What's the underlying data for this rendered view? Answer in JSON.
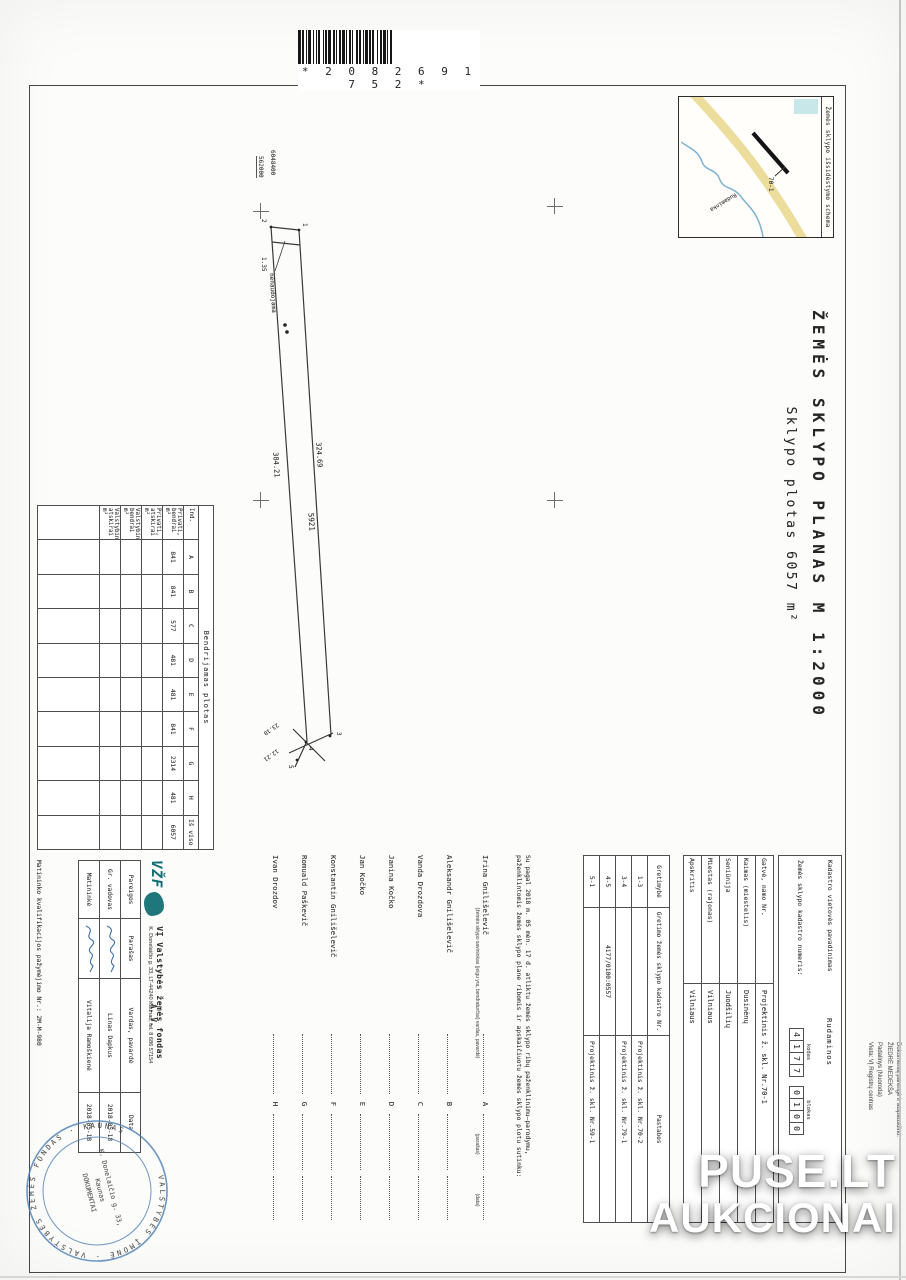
{
  "barcode": {
    "digits": "* 2 0 8 2 6 9 1 7 5 2 *"
  },
  "watermark": {
    "line1": "PUSE.LT",
    "line2": "AUKCIONAI"
  },
  "print_note": {
    "lines": [
      "Dokumentą parengė ir atspausdino:",
      "ŽIEDRĖ MEDEKŠA",
      "Padalinys (Nuoroda)",
      "Vieta: VĮ Registrų centras"
    ]
  },
  "title": {
    "main": "ŽEMĖS SKLYPO PLANAS M 1:2000",
    "subtitle": "Sklypo plotas 6057 m²"
  },
  "inset": {
    "caption": "Žemės sklypo išsidėstymo schema",
    "river_label": "Rudaminka",
    "plot_label": "70-1"
  },
  "grid": {
    "northing": "6048400",
    "easting": "562000"
  },
  "parcel": {
    "len_top": "324.69",
    "len_bottom": "384.21",
    "area_label": "5921",
    "unused_label": "nenaudojama",
    "dim_small": "1.35",
    "end_dim_1": "23.10",
    "end_dim_2": "12.21",
    "points": [
      "1",
      "2",
      "3",
      "4",
      "5"
    ]
  },
  "area_table": {
    "title": "Bendrijamas plotas",
    "col_ind": "Ind.",
    "parts": [
      "A",
      "B",
      "C",
      "D",
      "E",
      "F",
      "G",
      "H"
    ],
    "values": [
      "841",
      "841",
      "577",
      "481",
      "481",
      "841",
      "2314",
      "481"
    ],
    "row_labels": [
      "Privati, bendrai m²",
      "Privati, atskirai m²",
      "Valstybinė, bendrai m²",
      "Valstybinė, atskirai m²"
    ],
    "total_label": "Iš viso",
    "total": "6057"
  },
  "cadastre": {
    "label_vietove": "Kadastro vietovės pavadinimas",
    "vietove": "Rudaminos",
    "label_number": "Žemės sklypo kadastro numeris:",
    "label_kodas": "kodas",
    "kodas_digits": [
      "4",
      "1",
      "7",
      "7"
    ],
    "label_blokas": "blokas",
    "blokas_digits": [
      "0",
      "1",
      "0",
      "0"
    ]
  },
  "address": {
    "rows": [
      [
        "Gatvė, namo Nr.",
        "Projektinis ž. skl. Nr.70-1"
      ],
      [
        "Kaimas (miestelis)",
        "Dusinėnų"
      ],
      [
        "Seniūnija",
        "Juodšilių"
      ],
      [
        "Miestas (rajonas)",
        "Vilniaus"
      ],
      [
        "Apskritis",
        "Vilniaus"
      ]
    ]
  },
  "neighbours": {
    "headers": [
      "Gretimybė",
      "Gretimo žemės sklypo kadastro Nr.",
      "Pastabos"
    ],
    "rows": [
      [
        "1-3",
        "",
        "Projektinis ž. skl. Nr.70-2"
      ],
      [
        "3-4",
        "",
        "Projektinis ž. skl. Nr.79-1"
      ],
      [
        "4-5",
        "4177/0100:0557",
        ""
      ],
      [
        "5-1",
        "",
        "Projektinis ž. skl. Nr.59-1"
      ]
    ]
  },
  "consent": {
    "intro1": "Su pagal 2018 m. 05 mėn. 17 d. atliktu žemės sklypo ribų paženklinimu–parodymu,",
    "intro2": "paženklintomis žemės sklypo plane ribomis ir apskaičiuotu žemės sklypo plotu sutinku:",
    "caption_owner": "(žemės sklypo savininkas (jeigu yra, bendraturčiai) vardas, pavardė)",
    "caption_sig": "(parašas)",
    "caption_date": "(data)",
    "names": [
      {
        "name": "Irina Gnilišelevič",
        "letter": "A"
      },
      {
        "name": "Aleksandr Gnilišelevič",
        "letter": "B"
      },
      {
        "name": "Vanda Drozdova",
        "letter": "C"
      },
      {
        "name": "Janina Kočko",
        "letter": "D"
      },
      {
        "name": "Jan Kočko",
        "letter": "E"
      },
      {
        "name": "Konstantin Gnilišelevič",
        "letter": "F"
      },
      {
        "name": "Romuald Paškevič",
        "letter": "G"
      },
      {
        "name": "Ivan Drozdov",
        "letter": "H"
      }
    ]
  },
  "firm": {
    "logo": "VŽF",
    "name": "VĮ Valstybės žemės fondas",
    "address": "K. Donelaičio g. 33, LT-44240 Kaunas, tel. 8 686 57154",
    "headers": [
      "Pareigos",
      "Parašas",
      "Vardas, pavardė",
      "Data"
    ],
    "rows": [
      {
        "role": "Gr. vadovas",
        "person": "Linas Dapkus",
        "date": "2018-05-18"
      },
      {
        "role": "Matininkė",
        "person": "Vitalija Ramoškienė",
        "date": "2018-05-18"
      }
    ],
    "qualification": "Matininko kvalifikacijos pažymėjimo Nr.:  2M-M-980",
    "av": "A. V."
  },
  "stamp": {
    "ring_text": "VALSTYBĖS ĮMONĖ · VALSTYBĖS ŽEMĖS FONDAS · KAUNAS",
    "center": [
      "K. Donelaičio g. 33,",
      "Kaunas",
      "DOKUMENTAI"
    ]
  },
  "colors": {
    "ink": "#2e2e2e",
    "stamp_blue": "#4f81b8",
    "logo_teal": "#0d6b70",
    "road_yellow": "#e6d27e",
    "river_blue": "#7fb2d0"
  }
}
